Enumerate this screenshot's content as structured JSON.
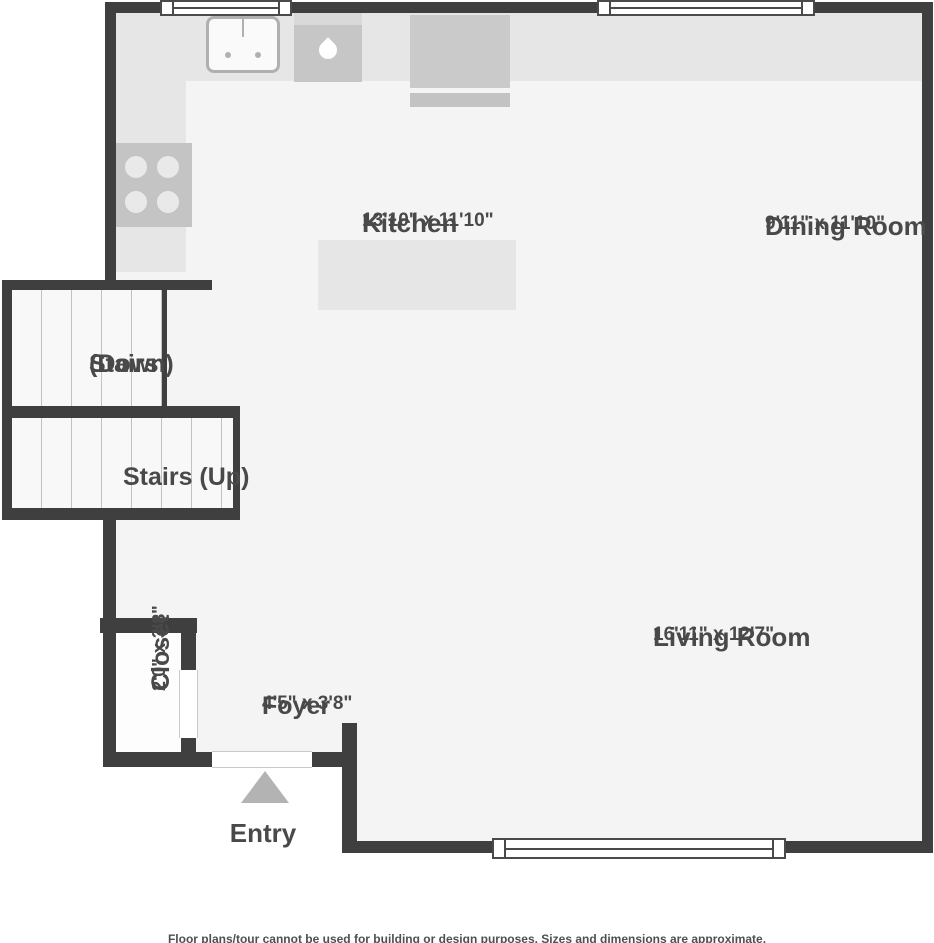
{
  "plan": {
    "kitchen": {
      "name": "Kitchen",
      "dims": "13'10\" x 11'10\""
    },
    "dining": {
      "name": "Dining Room",
      "dims": "9'11\" x 11'10\""
    },
    "living": {
      "name": "Living Room",
      "dims": "16'11\" x 12'7\""
    },
    "foyer": {
      "name": "Foyer",
      "dims": "4'5\" x 3'8\""
    },
    "closet": {
      "name": "Closet",
      "dims": "2'0\" x 3'8\""
    },
    "stairs_down": {
      "line1": "Stairs",
      "line2": "(Down)"
    },
    "stairs_up": {
      "label": "Stairs (Up)"
    },
    "entry": {
      "label": "Entry"
    },
    "disclaimer": "Floor plans/tour cannot be used for building or design purposes. Sizes and dimensions are approximate.",
    "colors": {
      "wall": "#3f3f3f",
      "floor": "#f4f4f4",
      "counter": "#e6e6e6",
      "appliance_dark": "#c6c6c6",
      "fixture_light": "#fafafa",
      "text": "#494949",
      "arrow": "#b3b3b3"
    }
  }
}
